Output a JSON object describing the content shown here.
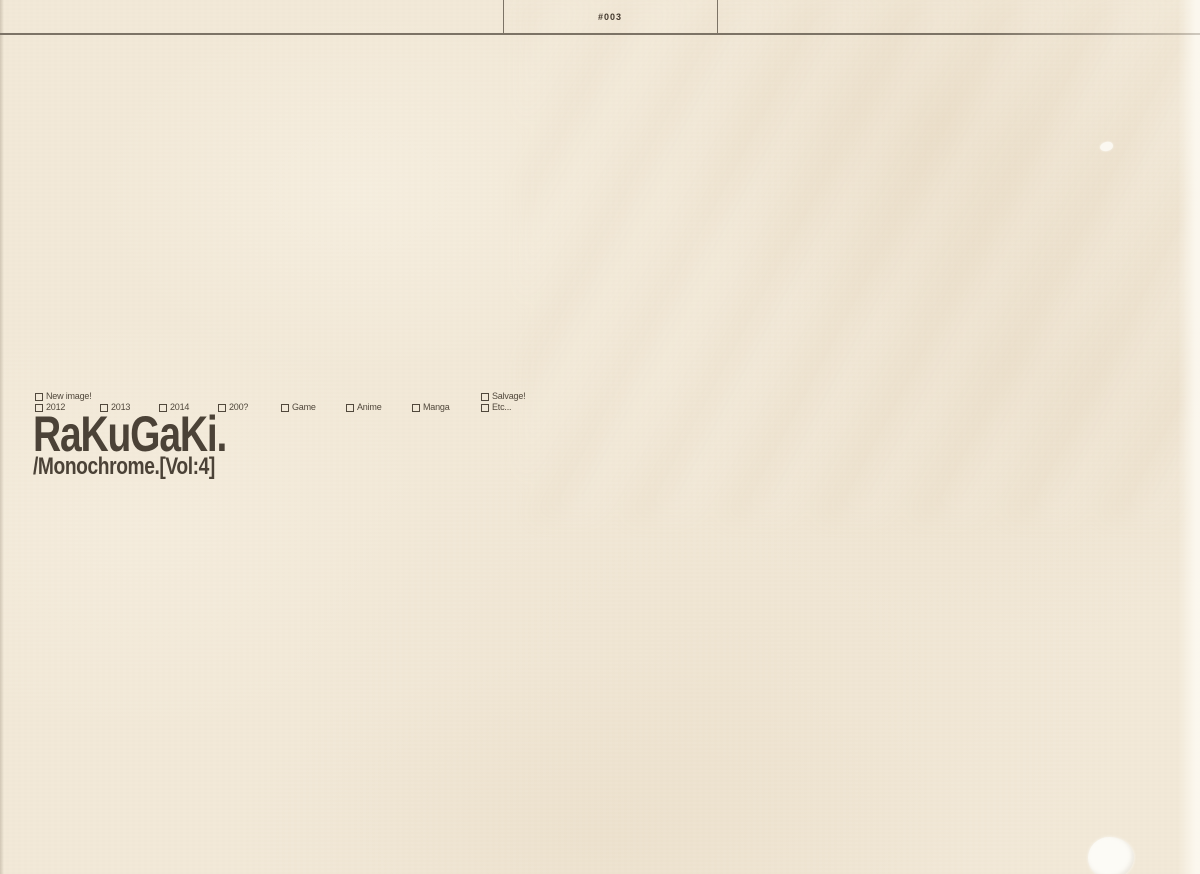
{
  "header": {
    "page_number": "#003"
  },
  "tags": {
    "items": [
      {
        "label": "New image!"
      },
      {
        "label": "2012"
      },
      {
        "label": "2013"
      },
      {
        "label": "2014"
      },
      {
        "label": "200?"
      },
      {
        "label": "Game"
      },
      {
        "label": "Anime"
      },
      {
        "label": "Manga"
      },
      {
        "label": "Salvage!"
      },
      {
        "label": "Etc..."
      }
    ]
  },
  "title": {
    "main": "RaKuGaKi.",
    "sub": "/Monochrome.[Vol:4]"
  },
  "colors": {
    "paper": "#f2e9d8",
    "ink": "#4b4237",
    "rule": "#7c7366",
    "tag_ink": "#51483c"
  }
}
